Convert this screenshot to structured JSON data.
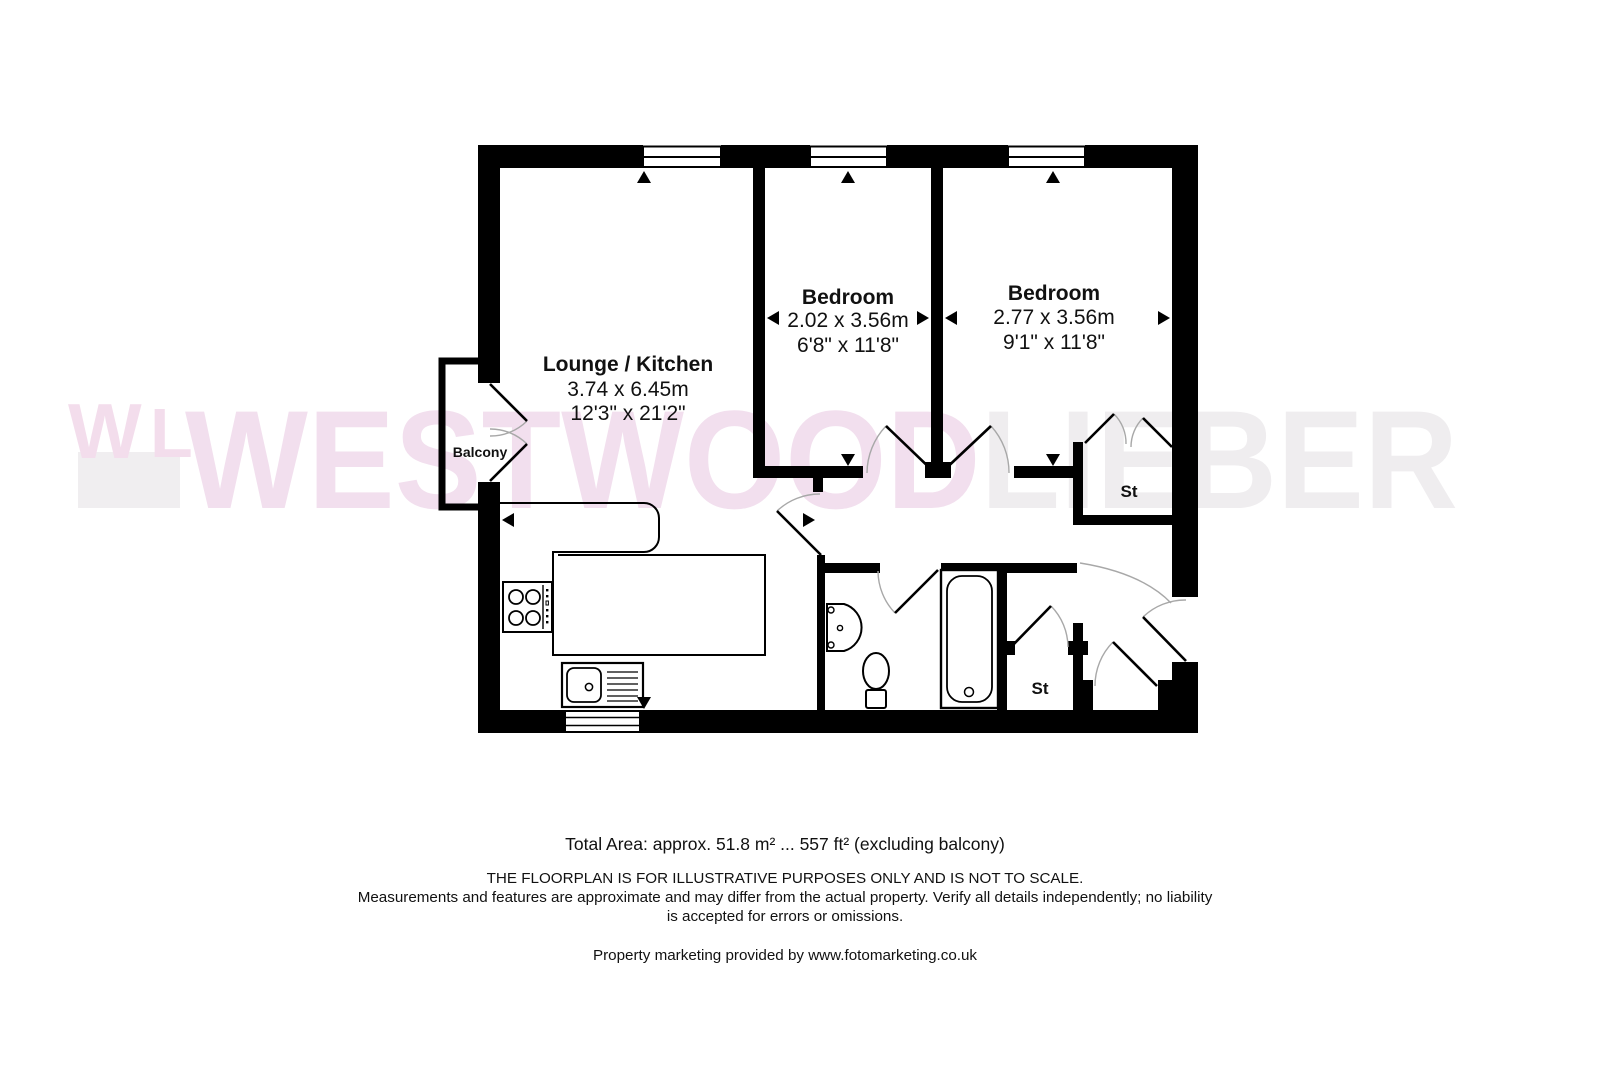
{
  "watermark": {
    "logo_w": "W",
    "logo_l": "L",
    "brand_pink": "WESTWOOD",
    "brand_gray": "LIEBER",
    "pink_color": "#f2dfee",
    "gray_color": "#efedef"
  },
  "floorplan": {
    "wall_color": "#000000",
    "arc_color": "#a8a8a8",
    "rooms": [
      {
        "name": "Lounge / Kitchen",
        "metric": "3.74 x 6.45m",
        "imperial": "12'3\" x 21'2\""
      },
      {
        "name": "Bedroom",
        "metric": "2.02 x 3.56m",
        "imperial": "6'8\" x 11'8\""
      },
      {
        "name": "Bedroom",
        "metric": "2.77 x 3.56m",
        "imperial": "9'1\" x 11'8\""
      }
    ],
    "labels": {
      "balcony": "Balcony",
      "storage_top": "St",
      "storage_bottom": "St"
    }
  },
  "footer": {
    "total_area": "Total Area: approx. 51.8 m² ... 557 ft² (excluding balcony)",
    "disclaimer_1": "THE FLOORPLAN IS FOR ILLUSTRATIVE PURPOSES ONLY AND IS NOT TO SCALE.",
    "disclaimer_2": "Measurements and features are approximate and may differ from the actual property. Verify all details independently; no liability",
    "disclaimer_3": "is accepted for errors or omissions.",
    "credit": "Property marketing provided by www.fotomarketing.co.uk"
  }
}
